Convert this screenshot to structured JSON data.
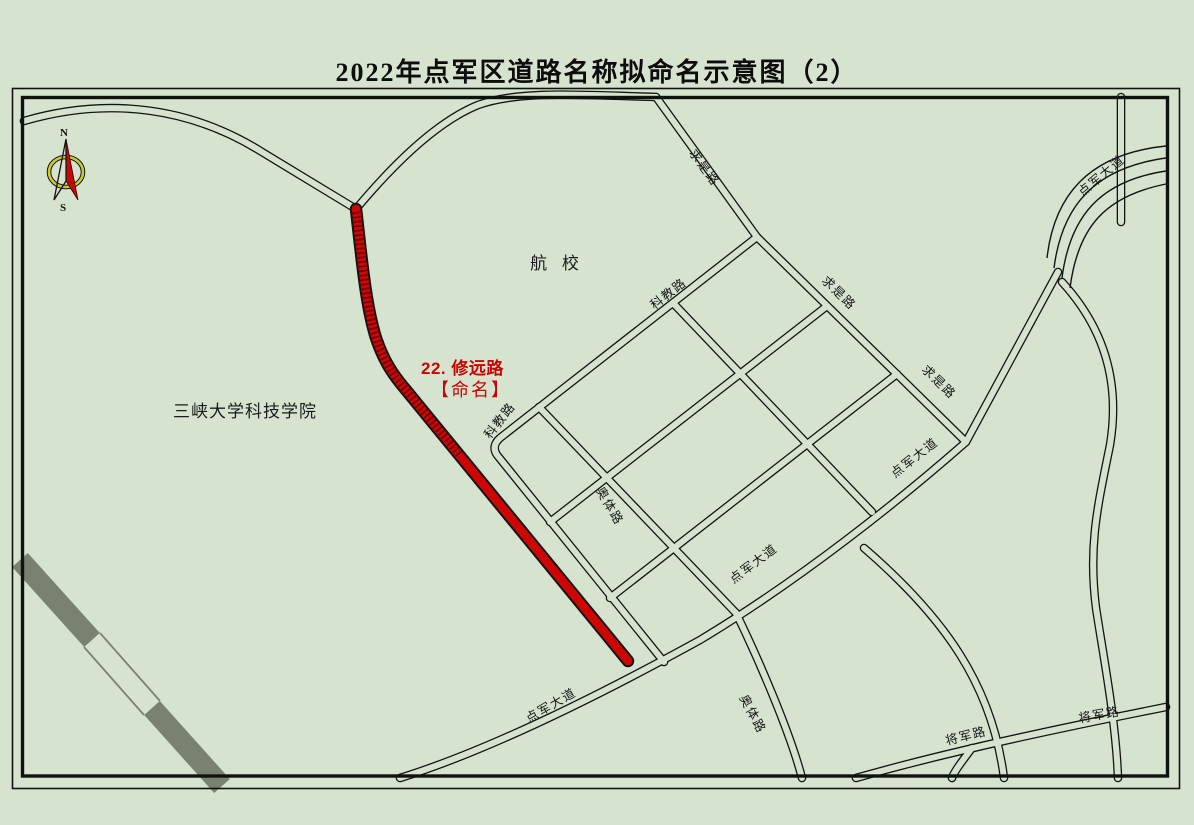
{
  "page": {
    "title": "2022年点军区道路名称拟命名示意图（2）"
  },
  "compass": {
    "north": "N",
    "south": "S"
  },
  "highlight": {
    "line1": "22. 修远路",
    "line2": "【命名】",
    "road_name": "修远路",
    "color": "#cc0000"
  },
  "places": {
    "aviation_school": "航 校",
    "university": "三峡大学科技学院"
  },
  "roads": {
    "labels": [
      {
        "name": "qiushi-lu-top",
        "text": "求是路"
      },
      {
        "name": "kejiao-lu-upper",
        "text": "科教路"
      },
      {
        "name": "qiushi-lu-mid",
        "text": "求是路"
      },
      {
        "name": "qiushi-lu-lower",
        "text": "求是路"
      },
      {
        "name": "dianjun-dadao-northeast",
        "text": "点军大道"
      },
      {
        "name": "kejiao-lu-lower",
        "text": "科教路"
      },
      {
        "name": "aoti-lu-upper",
        "text": "奥体路"
      },
      {
        "name": "dianjun-dadao-mid",
        "text": "点军大道"
      },
      {
        "name": "dianjun-dadao-mid2",
        "text": "点军大道"
      },
      {
        "name": "dianjun-dadao-southwest",
        "text": "点军大道"
      },
      {
        "name": "aoti-lu-lower",
        "text": "奥体路"
      },
      {
        "name": "jiangjun-lu-west",
        "text": "将军路"
      },
      {
        "name": "jiangjun-lu-east",
        "text": "将军路"
      }
    ]
  }
}
